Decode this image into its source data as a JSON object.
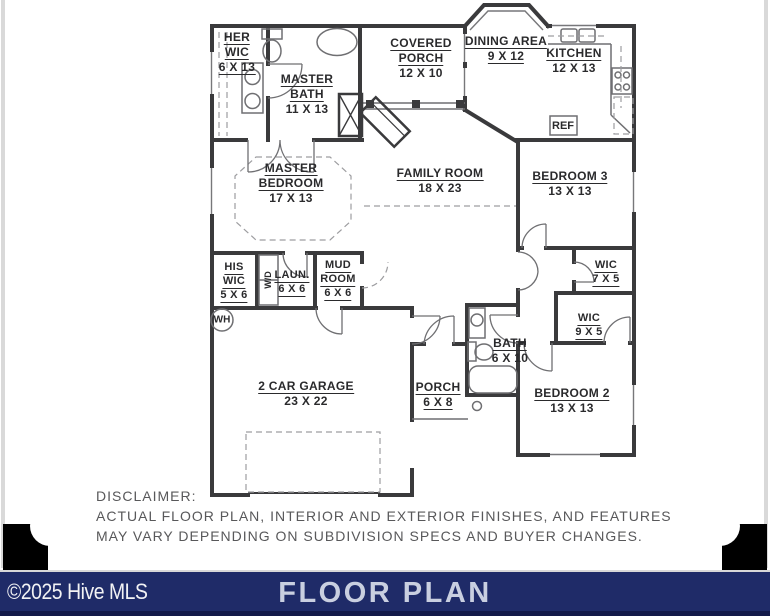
{
  "rooms": {
    "her_wic": {
      "l1": "HER",
      "l2": "WIC",
      "dims": "6 X 13"
    },
    "master_bath": {
      "l1": "MASTER",
      "l2": "BATH",
      "dims": "11 X 13"
    },
    "covered_porch": {
      "l1": "COVERED",
      "l2": "PORCH",
      "dims": "12 X 10"
    },
    "dining_area": {
      "l1": "DINING AREA",
      "dims": "9 X 12"
    },
    "kitchen": {
      "l1": "KITCHEN",
      "dims": "12 X 13"
    },
    "master_bedroom": {
      "l1": "MASTER",
      "l2": "BEDROOM",
      "dims": "17 X 13"
    },
    "family_room": {
      "l1": "FAMILY ROOM",
      "dims": "18 X 23"
    },
    "bedroom_3": {
      "l1": "BEDROOM 3",
      "dims": "13 X 13"
    },
    "his_wic": {
      "l1": "HIS",
      "l2": "WIC",
      "dims": "5 X 6"
    },
    "laundry": {
      "l1": "LAUN.",
      "dims": "6 X 6"
    },
    "mud_room": {
      "l1": "MUD",
      "l2": "ROOM",
      "dims": "6 X 6"
    },
    "wic_bed3": {
      "l1": "WIC",
      "dims": "7 X 5"
    },
    "wic_bed2": {
      "l1": "WIC",
      "dims": "9 X 5"
    },
    "bath": {
      "l1": "BATH",
      "dims": "6 X 10"
    },
    "garage": {
      "l1": "2 CAR GARAGE",
      "dims": "23 X 22"
    },
    "front_porch": {
      "l1": "PORCH",
      "dims": "6 X 8"
    },
    "bedroom_2": {
      "l1": "BEDROOM 2",
      "dims": "13 X 13"
    }
  },
  "fixtures": {
    "refrigerator": "REF",
    "water_heater": "WH",
    "washer_dryer": "W/D"
  },
  "disclaimer": {
    "title": "DISCLAIMER:",
    "line1": "ACTUAL FLOOR PLAN, INTERIOR AND EXTERIOR FINISHES, AND FEATURES",
    "line2": "MAY VARY DEPENDING ON SUBDIVISION SPECS AND BUYER CHANGES."
  },
  "footer": {
    "copyright": "©2025 Hive MLS",
    "title": "FLOOR PLAN"
  },
  "colors": {
    "wall": "#3a3a3c",
    "footer_bar": "#1f2b68",
    "footer_title_text": "#c9cfe0",
    "disclaimer_text": "#58585a",
    "corner_mark": "#000000"
  }
}
